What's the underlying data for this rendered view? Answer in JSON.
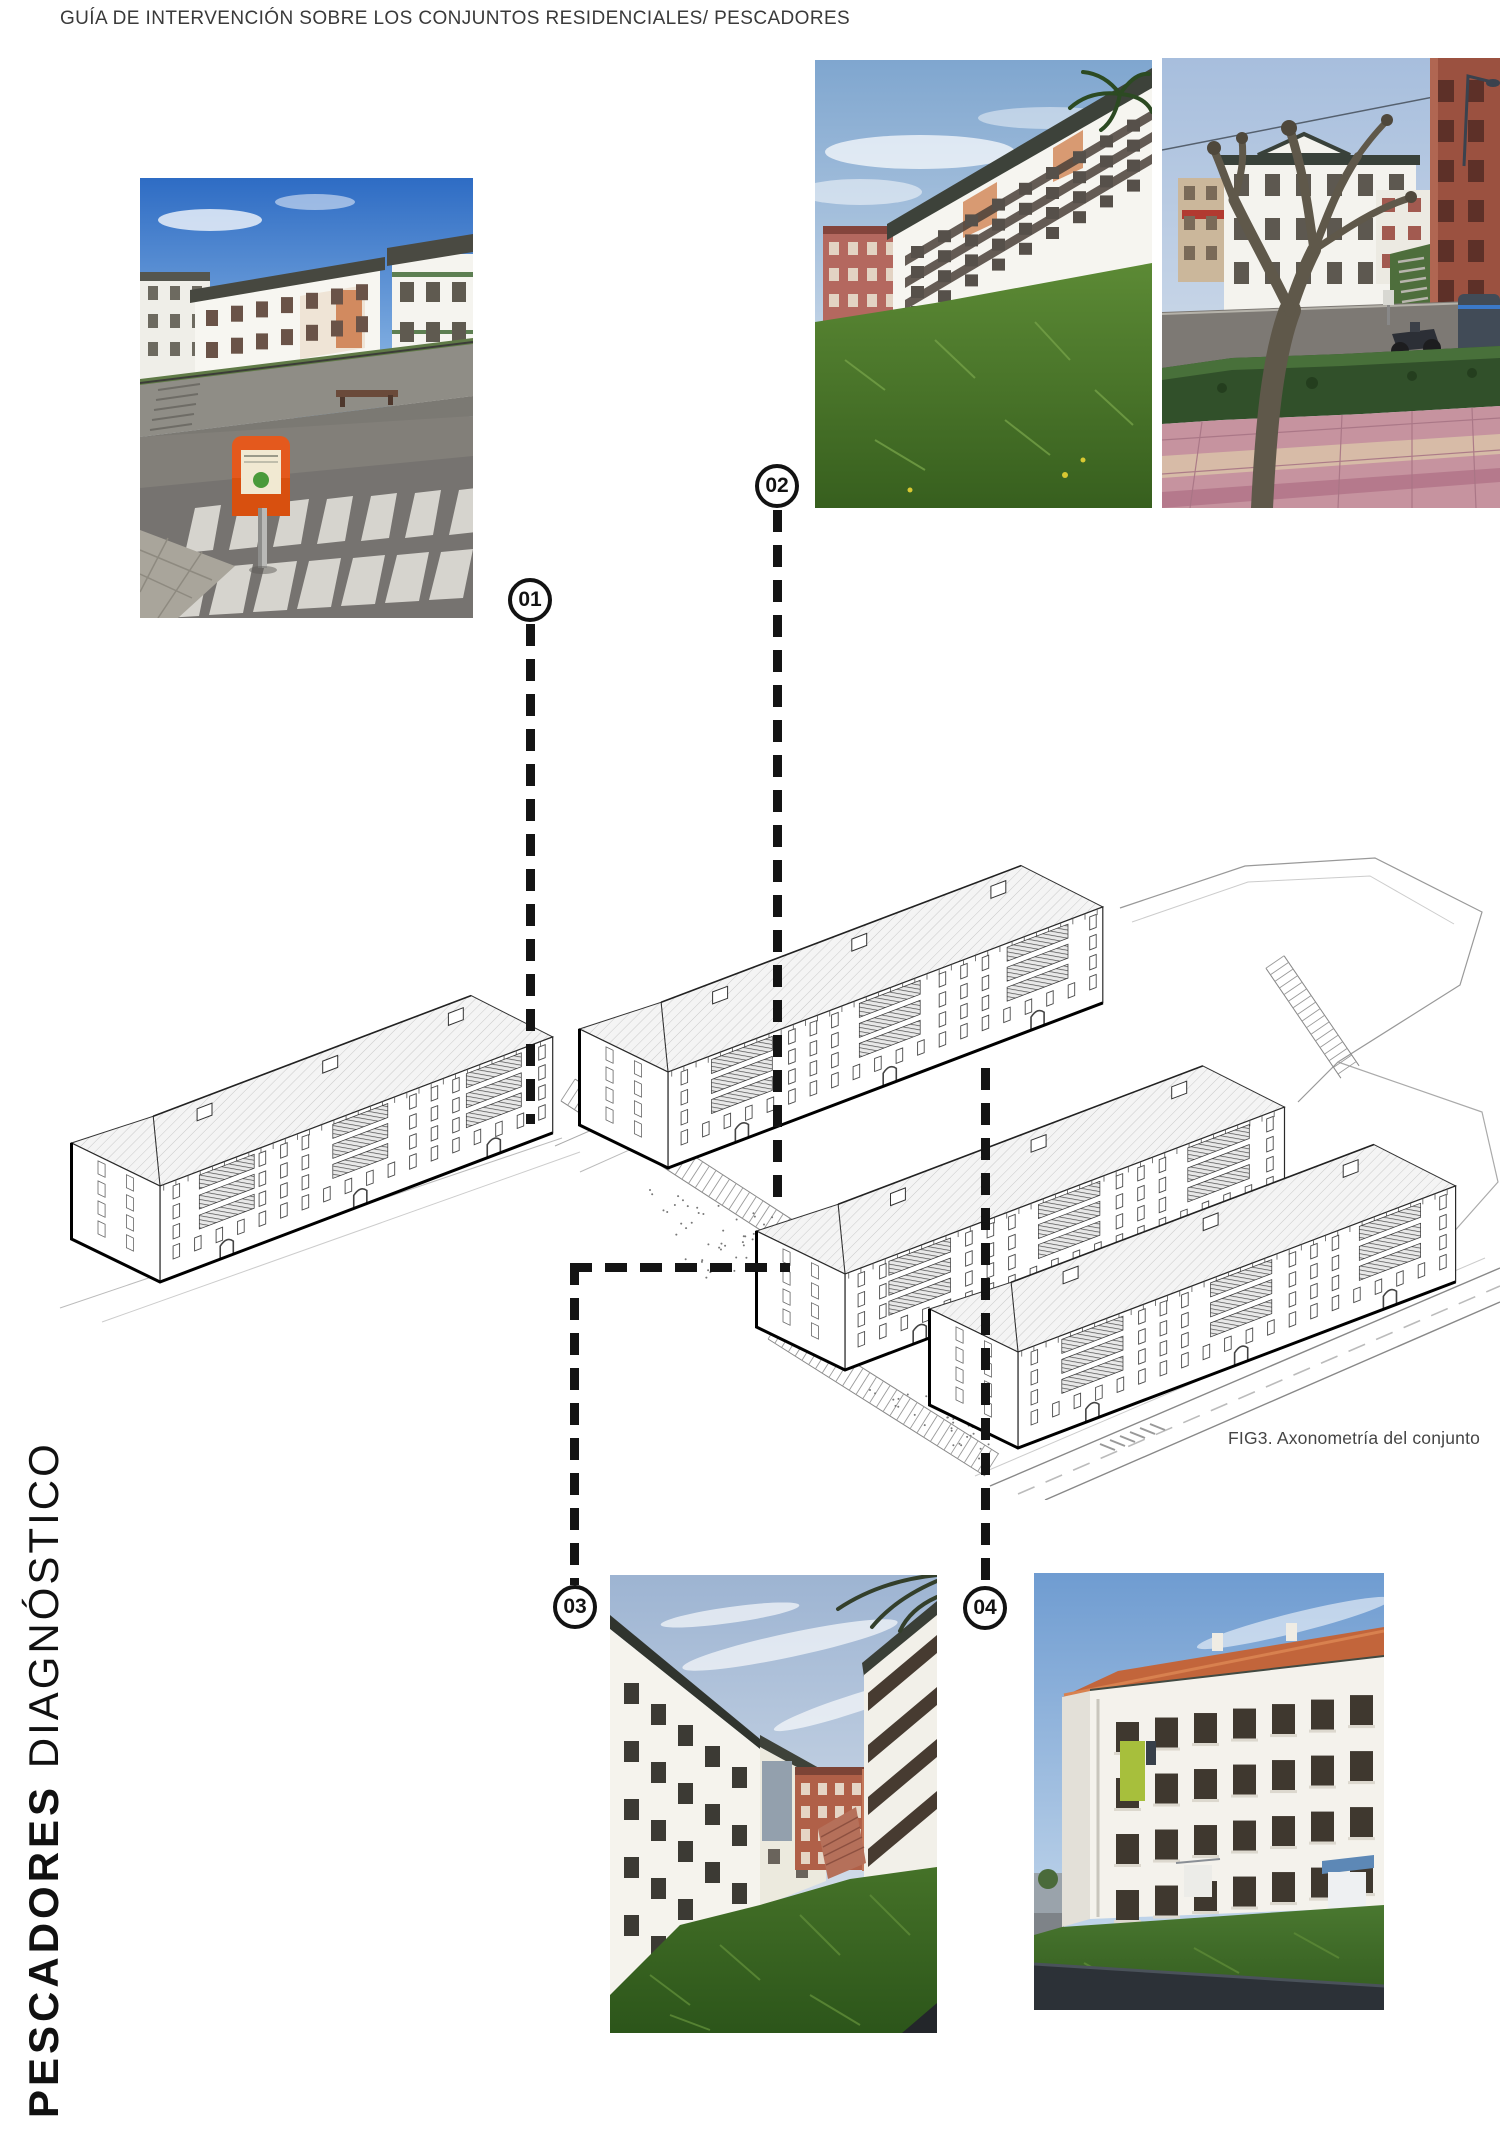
{
  "page": {
    "header": "GUÍA DE INTERVENCIÓN SOBRE LOS CONJUNTOS RESIDENCIALES/ PESCADORES",
    "sidebar": {
      "project": "PESCADORES",
      "section": "DIAGNÓSTICO"
    },
    "figure": {
      "caption": "FIG3. Axonometría del conjunto"
    }
  },
  "markers": [
    {
      "label": "01"
    },
    {
      "label": "02"
    },
    {
      "label": "03"
    },
    {
      "label": "04"
    }
  ],
  "photos": [
    {
      "id": "photo-01",
      "description": "Street corner with zebra crossing, orange recycling bin and white residential blocks on a slope"
    },
    {
      "id": "photo-02",
      "description": "White residential blocks with balconies above a green grass embankment"
    },
    {
      "id": "photo-03",
      "description": "Pollarded plane tree, hedge and pink paved sidewalk in front of white and brick buildings"
    },
    {
      "id": "photo-04",
      "description": "Courtyard between white blocks with grass slope, stairs and brick buildings behind"
    },
    {
      "id": "photo-05",
      "description": "White facade with orange roof, grid of windows and hanging laundry"
    }
  ],
  "colors": {
    "accent_orange_bin": "#e4591d",
    "grass_green": "#4c7a2e",
    "terracotta_roof": "#c2653b",
    "line_black": "#141414",
    "sky_blue": "#6f9cd1"
  }
}
